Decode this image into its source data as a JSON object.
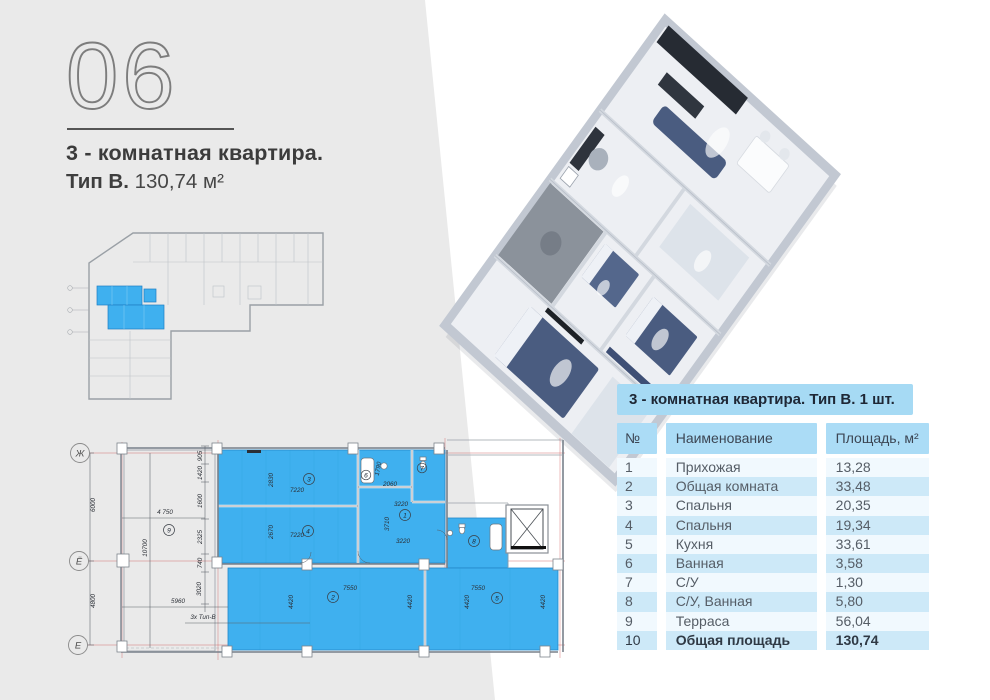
{
  "header": {
    "unit_number": "06",
    "title_line1": "3 - комнатная квартира.",
    "type_label": "Тип В.",
    "area_label": "130,74 м²"
  },
  "banner": {
    "text": "3 - комнатная квартира. Тип В. 1 шт."
  },
  "table": {
    "headers": {
      "num": "№",
      "name": "Наименование",
      "area": "Площадь, м²"
    },
    "rows": [
      {
        "num": "1",
        "name": "Прихожая",
        "area": "13,28"
      },
      {
        "num": "2",
        "name": "Общая комната",
        "area": "33,48"
      },
      {
        "num": "3",
        "name": "Спальня",
        "area": "20,35"
      },
      {
        "num": "4",
        "name": "Спальня",
        "area": "19,34"
      },
      {
        "num": "5",
        "name": "Кухня",
        "area": "33,61"
      },
      {
        "num": "6",
        "name": "Ванная",
        "area": "3,58"
      },
      {
        "num": "7",
        "name": "С/У",
        "area": "1,30"
      },
      {
        "num": "8",
        "name": "С/У, Ванная",
        "area": "5,80"
      },
      {
        "num": "9",
        "name": "Терраса",
        "area": "56,04"
      },
      {
        "num": "10",
        "name": "Общая площадь",
        "area": "130,74"
      }
    ]
  },
  "plan": {
    "axes": [
      {
        "t": "Ж"
      },
      {
        "t": "Ё"
      },
      {
        "t": "Е"
      }
    ],
    "room_circles": [
      {
        "t": "3"
      },
      {
        "t": "4"
      },
      {
        "t": "9"
      },
      {
        "t": "1"
      },
      {
        "t": "6"
      },
      {
        "t": "7"
      },
      {
        "t": "8"
      },
      {
        "t": "2"
      },
      {
        "t": "5"
      }
    ],
    "labels": [
      {
        "t": "6000"
      },
      {
        "t": "4800"
      },
      {
        "t": "905"
      },
      {
        "t": "1420"
      },
      {
        "t": "1600"
      },
      {
        "t": "2325"
      },
      {
        "t": "740"
      },
      {
        "t": "3020"
      },
      {
        "t": "4 750"
      },
      {
        "t": "10700"
      },
      {
        "t": "5960"
      },
      {
        "t": "3x Тип-В"
      },
      {
        "t": "2830"
      },
      {
        "t": "7220"
      },
      {
        "t": "2670"
      },
      {
        "t": "7220"
      },
      {
        "t": "3220"
      },
      {
        "t": "3710"
      },
      {
        "t": "3220"
      },
      {
        "t": "2060"
      },
      {
        "t": "1790"
      },
      {
        "t": "7550"
      },
      {
        "t": "4420"
      },
      {
        "t": "4420"
      },
      {
        "t": "7550"
      },
      {
        "t": "4420"
      },
      {
        "t": "4420"
      }
    ]
  },
  "colors": {
    "accent_blue": "#3fb0ef",
    "banner_blue": "#a6daf4",
    "row_light": "#f1f9fe",
    "row_dark": "#cde9f8",
    "backdrop_gray": "#eaeaea"
  }
}
